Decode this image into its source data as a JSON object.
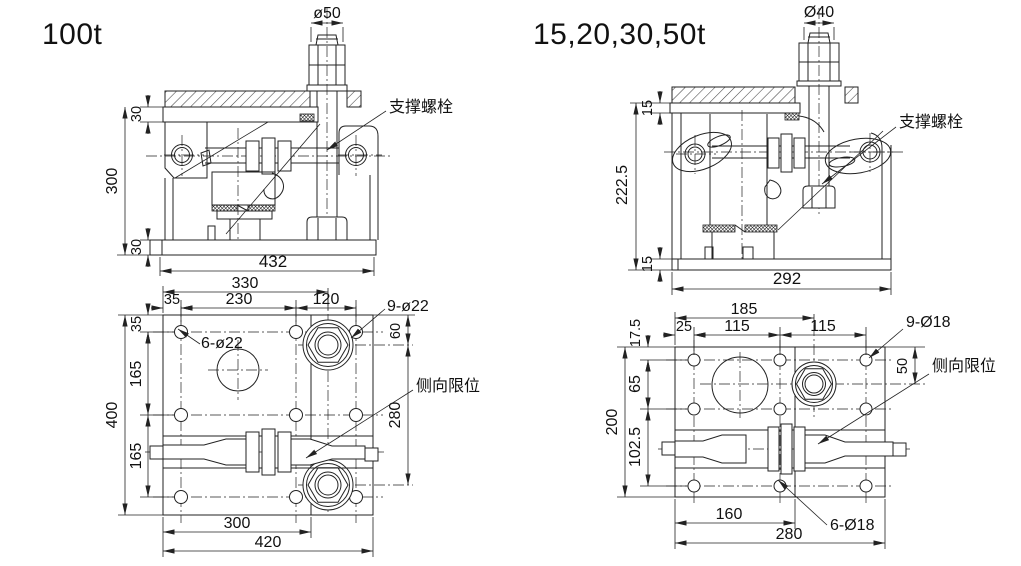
{
  "colors": {
    "line": "#222222",
    "background": "#ffffff"
  },
  "figures": [
    {
      "title": "100t",
      "elevation": {
        "bolt_dia": "ø50",
        "support_bolt_label": "支撑螺栓",
        "dim_top_plate": "30",
        "dim_height": "300",
        "dim_bottom_plate": "30",
        "dim_width": "432"
      },
      "plan": {
        "dim_bolt_offset": "330",
        "dim_edge_h": "35",
        "dim_mid_h": "230",
        "dim_right_h": "120",
        "label_9_holes": "9-ø22",
        "dim_edge_v": "35",
        "label_6_holes": "6-ø22",
        "dim_row1": "165",
        "dim_total_v": "400",
        "dim_row2": "165",
        "dim_hex_top": "60",
        "dim_hex_span": "280",
        "label_side_limit": "侧向限位",
        "dim_300": "300",
        "dim_total_h": "420"
      }
    },
    {
      "title": "15,20,30,50t",
      "elevation": {
        "bolt_dia": "Ø40",
        "support_bolt_label": "支撑螺栓",
        "dim_top_plate": "15",
        "dim_height": "222.5",
        "dim_bottom_plate": "15",
        "dim_width": "292"
      },
      "plan": {
        "dim_bolt_offset": "185",
        "dim_edge_h": "25",
        "dim_mid_h": "115",
        "dim_right_h": "115",
        "label_9_holes": "9-Ø18",
        "dim_edge_v": "17.5",
        "dim_row1": "65",
        "dim_total_v": "200",
        "dim_row2": "102.5",
        "dim_hex_top": "50",
        "label_side_limit": "侧向限位",
        "dim_160": "160",
        "label_6_holes": "6-Ø18",
        "dim_total_h": "280"
      }
    }
  ]
}
